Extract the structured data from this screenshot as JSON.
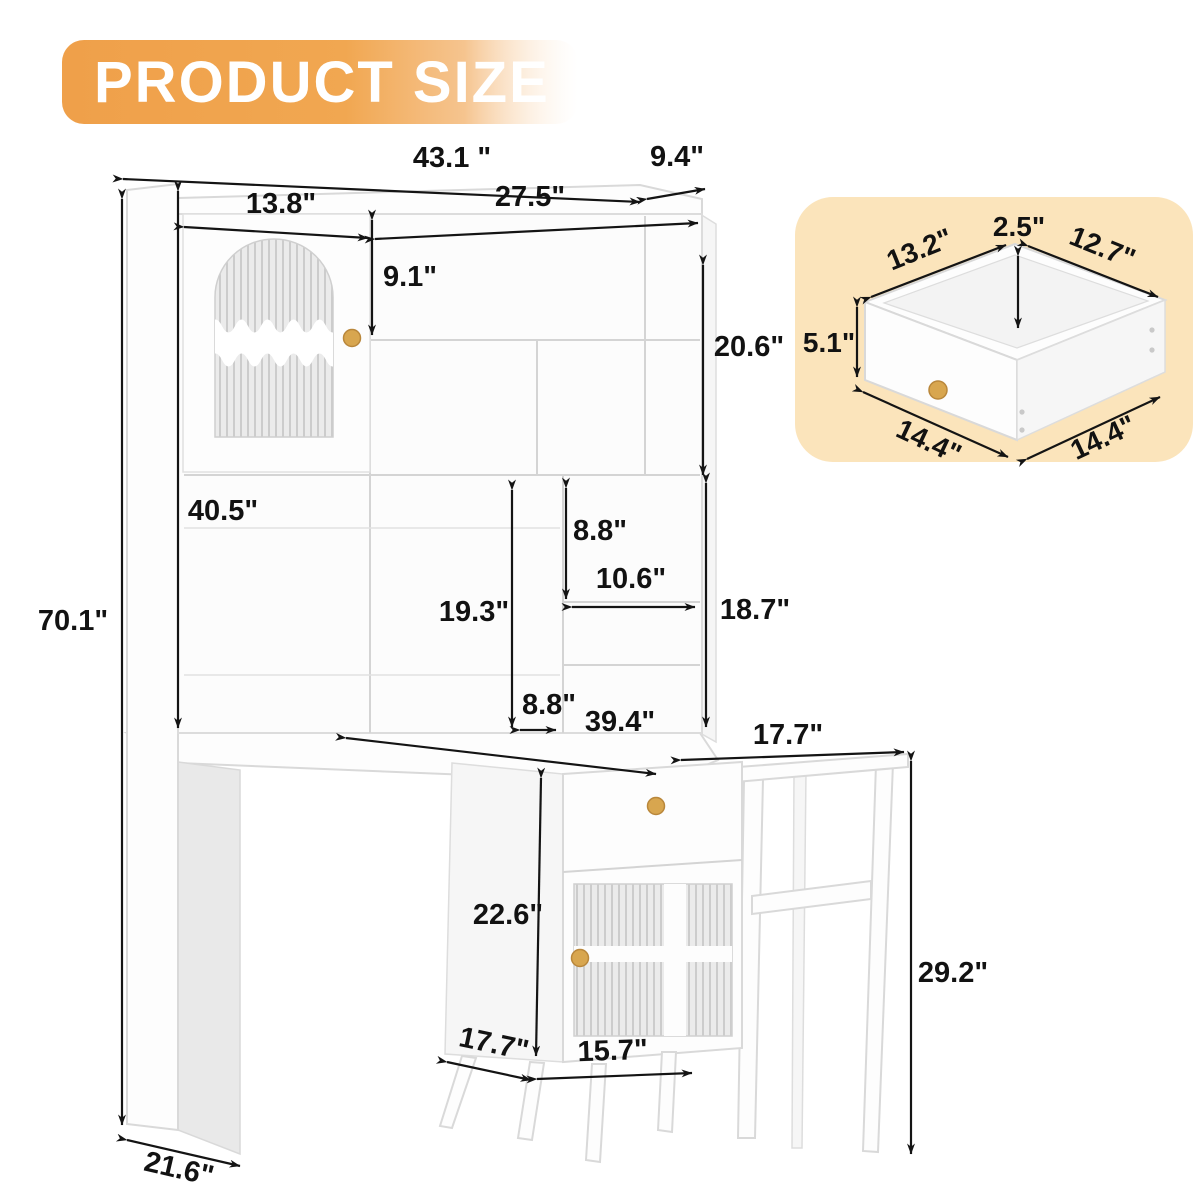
{
  "title": {
    "text": "PRODUCT SIZE"
  },
  "colors": {
    "badge_orange": "#f0a24c",
    "inset_background": "#fbe4bb",
    "dimension_ink": "#121212",
    "knob_gold": "#d8a64f",
    "furniture_white": "#fdfdfd"
  },
  "main_diagram": {
    "name": "desk-with-hutch-dimension-drawing",
    "dims": {
      "overall_width": "43.1 \"",
      "top_depth": "9.4\"",
      "hutch_left_width": "13.8\"",
      "hutch_right_width": "27.5\"",
      "top_shelf_height": "9.1\"",
      "upper_right_height": "20.6\"",
      "hutch_opening_height": "40.5\"",
      "overall_height": "70.1\"",
      "lower_open_height": "19.3\"",
      "cubby_height": "8.8\"",
      "cubby_width": "10.6\"",
      "right_column_height": "18.7\"",
      "column_depth": "8.8\"",
      "desk_width": "39.4\"",
      "side_table_width": "17.7\"",
      "side_table_height": "29.2\"",
      "cabinet_height": "22.6\"",
      "cabinet_depth": "17.7\"",
      "cabinet_width": "15.7\"",
      "base_depth": "21.6\""
    }
  },
  "inset_diagram": {
    "name": "drawer-dimension-drawing",
    "dims": {
      "top_inner_height": "2.5\"",
      "inner_width": "13.2\"",
      "inner_depth": "12.7\"",
      "front_height": "5.1\"",
      "outer_width": "14.4\"",
      "outer_depth": "14.4\""
    }
  }
}
